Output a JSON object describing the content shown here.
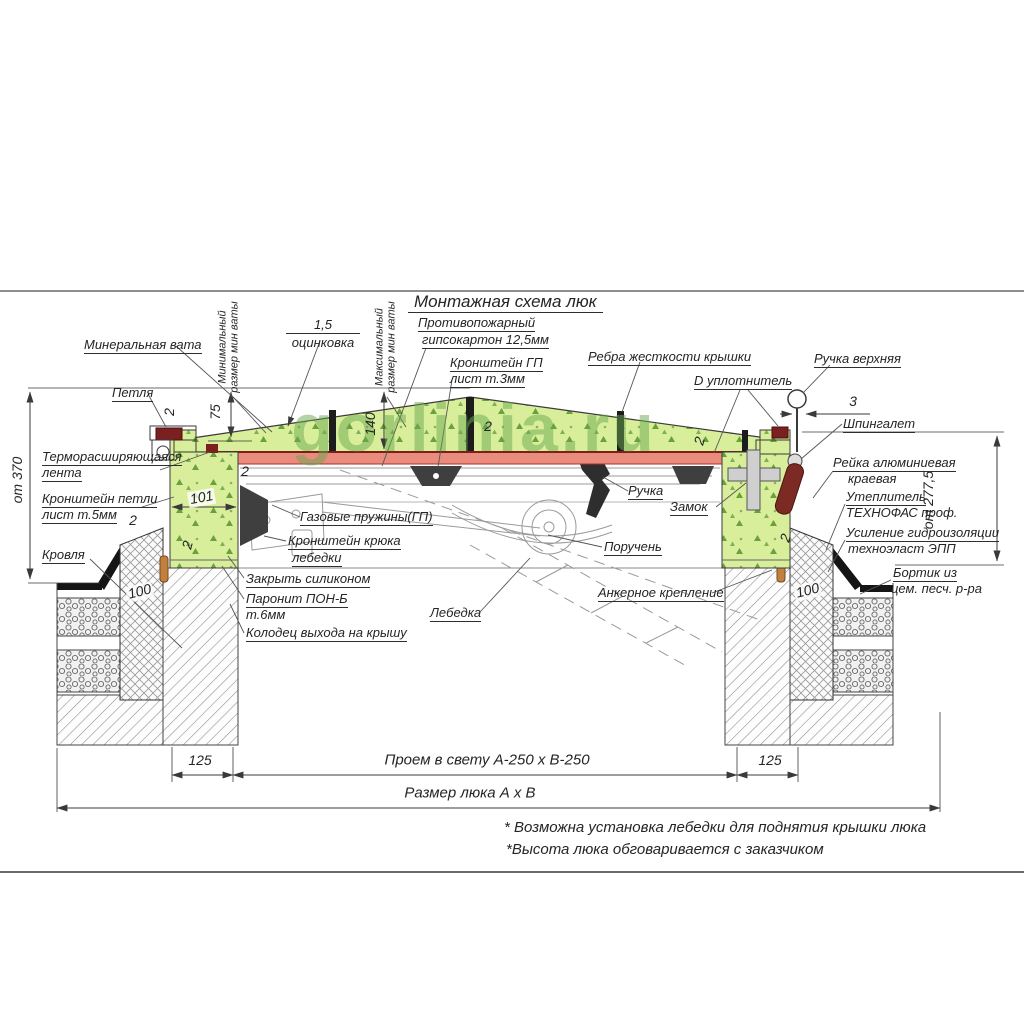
{
  "title": "Монтажная схема люк",
  "watermark": "gorlinia.ru",
  "labels": {
    "mineral_wool": "Минеральная вата",
    "hinge": "Петля",
    "min_wool": "Минимальный\nразмер мин ваты",
    "max_wool": "Максимальный\nразмер мин ваты",
    "zinc_thickness": "1,5",
    "zinc": "оцинковка",
    "fireproof1": "Противопожарный",
    "fireproof2": "гипсокартон 12,5мм",
    "gp_bracket1": "Кронштейн ГП",
    "gp_bracket2": "лист т.3мм",
    "ribs": "Ребра жесткости крышки",
    "seal": "D уплотнитель",
    "top_handle": "Ручка верхняя",
    "latch": "Шпингалет",
    "alu_rail1": "Рейка алюминиевая",
    "alu_rail2": "краевая",
    "insulation1": "Утеплитель",
    "insulation2": "ТЕХНОФАС проф.",
    "waterproof1": "Усиление гидроизоляции",
    "waterproof2": "техноэласт ЭПП",
    "curb1": "Бортик из",
    "curb2": "цем. песч. р-ра",
    "thermo1": "Терморасширяющаяся",
    "thermo2": "лента",
    "hinge_bracket1": "Кронштейн петли",
    "hinge_bracket2": "лист т.5мм",
    "roof": "Кровля",
    "silicone": "Закрыть силиконом",
    "paronite1": "Паронит ПОН-Б",
    "paronite2": "т.6мм",
    "well": "Колодец выхода на крышу",
    "gas_springs": "Газовые пружины(ГП)",
    "hook_bracket1": "Кронштейн крюка",
    "hook_bracket2": "лебедки",
    "winch": "Лебедка",
    "handle": "Ручка",
    "lock": "Замок",
    "handrail": "Поручень",
    "anchor": "Анкерное крепление"
  },
  "dimensions": {
    "h370": "от 370",
    "h277": "от 277,5",
    "d75": "75",
    "d140": "140",
    "d101": "101",
    "d100": "100",
    "d125": "125",
    "d3": "3",
    "d2": "2",
    "opening": "Проем в свету А-250 х В-250",
    "hatch_size": "Размер люка А х В"
  },
  "notes": [
    "* Возможна установка лебедки для поднятия крышки люка",
    "*Высота люка обговаривается с заказчиком"
  ],
  "colors": {
    "insulation_green": "#d9ee9b",
    "speck_green": "#69a23b",
    "lid_red": "#e98b7d",
    "seal_dark_red": "#7a2020",
    "watermark_green": "#6aa84f",
    "line_dark": "#3a3a3a"
  }
}
